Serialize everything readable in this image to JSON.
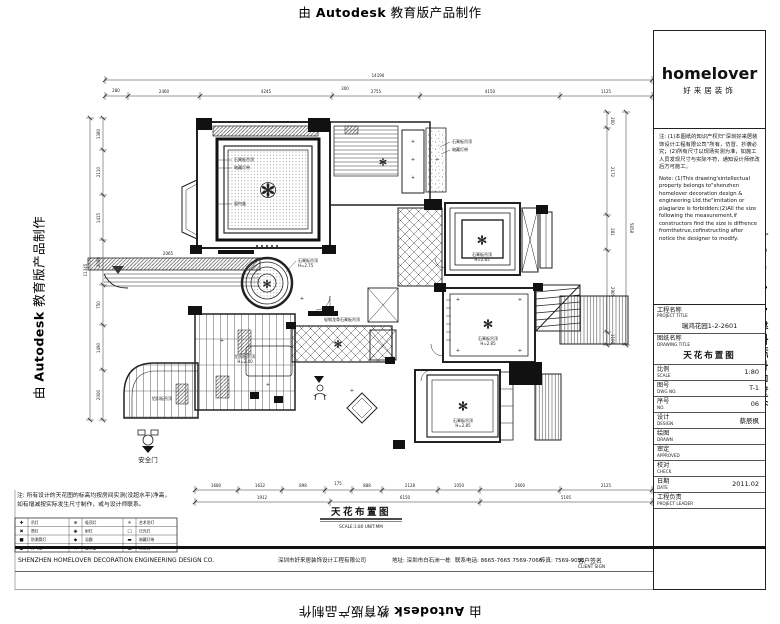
{
  "watermark": {
    "pre": "由",
    "brand": "Autodesk",
    "post": "教育版产品制作"
  },
  "logo": {
    "name": "homelover",
    "subtitle": "好来居装饰"
  },
  "title_block": {
    "note_cn": "注: (1)本图纸的知识产权归“深圳好来居装饰设计工程有限公司”所有，仿冒、抄袭必究；(2)所有尺寸以现场实测为准，如施工人员发现尺寸与实际不符，通知设计师修改后方可施工。",
    "note_en": "Note: (1)This drawing'sintellectual property belongs to\"shenzhen homelover decoration design & engineering Ltd.the\"imitation or plagiarize is forbidden;(2)All the size following the measurement,if constructors find the size is diffrence fromthetrue,cofinstructing after notice the designer to modify.",
    "fields": [
      {
        "cn": "工程名称",
        "en": "PROJECT TITLE",
        "value": "瑞鸿花园1-2-2601",
        "block": true
      },
      {
        "cn": "图纸名称",
        "en": "DRAWING TITLE",
        "value": "天花布置图",
        "block": true,
        "em": true
      },
      {
        "cn": "比例",
        "en": "SCALE",
        "value": "1:80"
      },
      {
        "cn": "图号",
        "en": "DWG NO.",
        "value": "T-1"
      },
      {
        "cn": "序号",
        "en": "NO.",
        "value": "06"
      },
      {
        "cn": "设计",
        "en": "DESIGN",
        "value": "蔡辰枫"
      },
      {
        "cn": "绘图",
        "en": "DRAWN",
        "value": ""
      },
      {
        "cn": "审定",
        "en": "APPROVED",
        "value": ""
      },
      {
        "cn": "校对",
        "en": "CHECK",
        "value": ""
      },
      {
        "cn": "日期",
        "en": "DATE",
        "value": "2011.02"
      },
      {
        "cn": "工程负责",
        "en": "PROJECT LEADER",
        "value": ""
      }
    ],
    "client_sign": {
      "cn": "客户签名",
      "en": "CLIENT SIGN"
    }
  },
  "footer": {
    "company_en": "SHENZHEN HOMELOVER  DECORATION ENGINEERING DESIGN CO.",
    "company_cn": "深圳市好来居装饰设计工程有限公司",
    "address": "地址: 深圳市白石洲一栋",
    "phone": "联系电话: 8665-7665  7569-7066",
    "fax": "传真: 7569-9055"
  },
  "notes_bottom": {
    "line1": "注: 所有设计的天花图的标高均按房间实测(没超水平)净高，",
    "line2": "如有增减按实际发生尺寸制作，或与设计师联系。"
  },
  "legend": {
    "items": [
      {
        "sym": "✚",
        "label": "吊灯"
      },
      {
        "sym": "⊕",
        "label": "吸顶灯"
      },
      {
        "sym": "✳",
        "label": "艺术吊灯"
      },
      {
        "sym": "✖",
        "label": "筒灯"
      },
      {
        "sym": "◉",
        "label": "射灯"
      },
      {
        "sym": "□",
        "label": "日光灯"
      },
      {
        "sym": "■",
        "label": "防潮筒灯"
      },
      {
        "sym": "◆",
        "label": "浴霸"
      },
      {
        "sym": "▬",
        "label": "暗藏灯带"
      },
      {
        "sym": "●",
        "label": "排气扇"
      },
      {
        "sym": "∩",
        "label": "窗帘盒"
      },
      {
        "sym": "▦",
        "label": "检修口"
      }
    ]
  },
  "plan": {
    "title": "天花布置图",
    "subtitle": "SCALE:1:80  UNIT:MM",
    "safety_door": "安全门",
    "dim_lines": [
      {
        "o": "h",
        "p": 80,
        "a": 105,
        "b": 652,
        "ticks": [
          105,
          652
        ],
        "labels": [
          {
            "t": "14190",
            "x": 378,
            "y": 77
          }
        ]
      },
      {
        "o": "h",
        "p": 96,
        "a": 105,
        "b": 652,
        "ticks": [
          105,
          128,
          200,
          332,
          420,
          560,
          652
        ],
        "labels": [
          {
            "t": "280",
            "x": 116,
            "y": 92
          },
          {
            "t": "2460",
            "x": 164,
            "y": 93
          },
          {
            "t": "4245",
            "x": 266,
            "y": 93
          },
          {
            "t": "300",
            "x": 345,
            "y": 90
          },
          {
            "t": "2755",
            "x": 376,
            "y": 93
          },
          {
            "t": "4150",
            "x": 490,
            "y": 93
          },
          {
            "t": "1125",
            "x": 606,
            "y": 93
          }
        ]
      },
      {
        "o": "v",
        "p": 103,
        "a": 118,
        "b": 420,
        "ticks": [
          118,
          150,
          195,
          240,
          285,
          325,
          370,
          420
        ],
        "labels": [
          {
            "t": "1380",
            "x": 100,
            "y": 134,
            "r": -90
          },
          {
            "t": "2110",
            "x": 100,
            "y": 172,
            "r": -90
          },
          {
            "t": "1415",
            "x": 100,
            "y": 218,
            "r": -90
          },
          {
            "t": "2090",
            "x": 100,
            "y": 262,
            "r": -90
          },
          {
            "t": "750",
            "x": 100,
            "y": 305,
            "r": -90
          },
          {
            "t": "1490",
            "x": 100,
            "y": 348,
            "r": -90
          },
          {
            "t": "2000",
            "x": 100,
            "y": 395,
            "r": -90
          }
        ]
      },
      {
        "o": "v",
        "p": 90,
        "a": 118,
        "b": 420,
        "ticks": [
          118,
          420
        ],
        "labels": [
          {
            "t": "11345",
            "x": 87,
            "y": 270,
            "r": -90
          }
        ]
      },
      {
        "o": "v",
        "p": 607,
        "a": 112,
        "b": 345,
        "ticks": [
          112,
          128,
          215,
          250,
          332,
          345
        ],
        "labels": [
          {
            "t": "200",
            "x": 611,
            "y": 121,
            "r": 90
          },
          {
            "t": "2172",
            "x": 611,
            "y": 172,
            "r": 90
          },
          {
            "t": "281",
            "x": 611,
            "y": 232,
            "r": 90
          },
          {
            "t": "2905",
            "x": 611,
            "y": 292,
            "r": 90
          },
          {
            "t": "1100",
            "x": 611,
            "y": 339,
            "r": 90
          }
        ]
      },
      {
        "o": "v",
        "p": 626,
        "a": 112,
        "b": 345,
        "ticks": [
          112,
          345
        ],
        "labels": [
          {
            "t": "5658",
            "x": 630,
            "y": 228,
            "r": 90
          }
        ]
      },
      {
        "o": "h",
        "p": 490,
        "a": 195,
        "b": 652,
        "ticks": [
          195,
          238,
          282,
          325,
          352,
          382,
          438,
          480,
          560,
          652
        ],
        "labels": [
          {
            "t": "1680",
            "x": 216,
            "y": 487
          },
          {
            "t": "1632",
            "x": 260,
            "y": 487
          },
          {
            "t": "898",
            "x": 303,
            "y": 487
          },
          {
            "t": "175",
            "x": 338,
            "y": 485
          },
          {
            "t": "888",
            "x": 367,
            "y": 487
          },
          {
            "t": "2128",
            "x": 410,
            "y": 487
          },
          {
            "t": "1050",
            "x": 459,
            "y": 487
          },
          {
            "t": "2660",
            "x": 520,
            "y": 487
          },
          {
            "t": "2125",
            "x": 606,
            "y": 487
          }
        ]
      },
      {
        "o": "h",
        "p": 502,
        "a": 195,
        "b": 652,
        "ticks": [
          195,
          330,
          480,
          652
        ],
        "labels": [
          {
            "t": "1912",
            "x": 262,
            "y": 499
          },
          {
            "t": "6150",
            "x": 405,
            "y": 499
          },
          {
            "t": "5195",
            "x": 566,
            "y": 499
          }
        ]
      }
    ],
    "annotations": [
      {
        "t": "石膏板吊顶",
        "x": 234,
        "y": 161,
        "an": "start"
      },
      {
        "t": "暗藏灯带",
        "x": 234,
        "y": 169,
        "an": "start"
      },
      {
        "t": "窗帘盒",
        "x": 234,
        "y": 205,
        "an": "start"
      },
      {
        "t": "石膏板吊顶",
        "x": 452,
        "y": 143,
        "an": "start"
      },
      {
        "t": "暗藏灯带",
        "x": 452,
        "y": 151,
        "an": "start"
      },
      {
        "t": "石膏板吊顶",
        "x": 482,
        "y": 256
      },
      {
        "t": "H=2.85",
        "x": 482,
        "y": 261
      },
      {
        "t": "石膏板吊顶",
        "x": 298,
        "y": 262,
        "an": "start"
      },
      {
        "t": "H=2.75",
        "x": 298,
        "y": 267,
        "an": "start"
      },
      {
        "t": "石膏板吊顶",
        "x": 488,
        "y": 340
      },
      {
        "t": "H=2.85",
        "x": 488,
        "y": 345
      },
      {
        "t": "石膏板吊顶",
        "x": 463,
        "y": 422
      },
      {
        "t": "H=2.85",
        "x": 463,
        "y": 427
      },
      {
        "t": "铝扣板吊顶",
        "x": 245,
        "y": 358
      },
      {
        "t": "H=2.40",
        "x": 245,
        "y": 363
      },
      {
        "t": "铝扣板吊顶",
        "x": 162,
        "y": 400
      },
      {
        "t": "轻钢龙骨石膏板吊顶",
        "x": 342,
        "y": 321
      },
      {
        "t": "2065",
        "x": 168,
        "y": 255
      },
      {
        "t": "+",
        "x": 413,
        "y": 143,
        "s": 5
      },
      {
        "t": "+",
        "x": 413,
        "y": 161,
        "s": 5
      },
      {
        "t": "+",
        "x": 413,
        "y": 179,
        "s": 5
      },
      {
        "t": "+",
        "x": 437,
        "y": 161,
        "s": 5
      },
      {
        "t": "+",
        "x": 352,
        "y": 392,
        "s": 5
      },
      {
        "t": "+",
        "x": 302,
        "y": 300,
        "s": 5
      },
      {
        "t": "+",
        "x": 458,
        "y": 301,
        "s": 5
      },
      {
        "t": "+",
        "x": 520,
        "y": 301,
        "s": 5
      },
      {
        "t": "+",
        "x": 458,
        "y": 352,
        "s": 5
      },
      {
        "t": "+",
        "x": 520,
        "y": 352,
        "s": 5
      },
      {
        "t": "+",
        "x": 222,
        "y": 342,
        "s": 5
      },
      {
        "t": "+",
        "x": 268,
        "y": 386,
        "s": 5
      }
    ]
  }
}
